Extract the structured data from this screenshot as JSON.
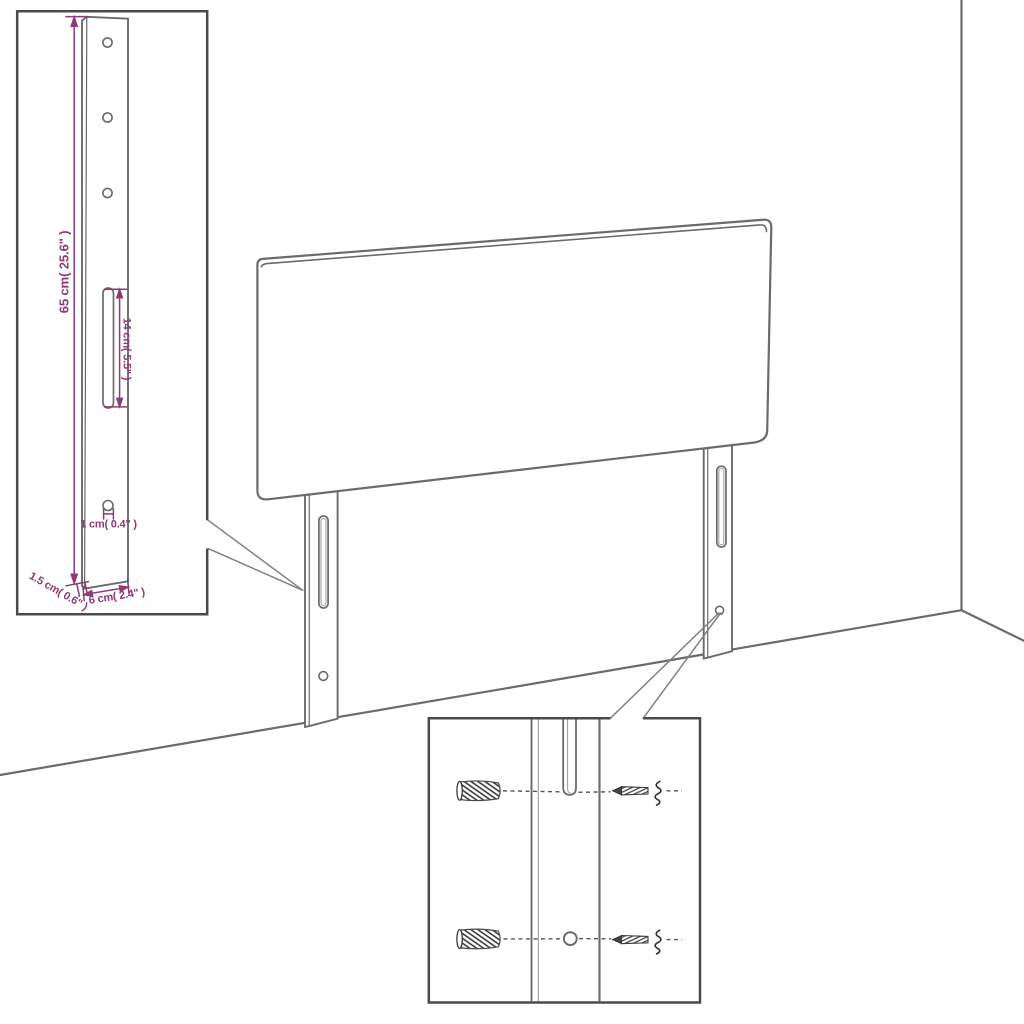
{
  "diagram": {
    "type": "furniture-assembly-dimension-diagram",
    "subject": "upholstered headboard with two slotted mounting legs shown against a room corner, with two magnifier detail insets",
    "colors": {
      "background": "#ffffff",
      "line": "#6b6b6b",
      "inset_border": "#4a4a4a",
      "dimension": "#8e3a74",
      "hardware": "#2f2f2f"
    },
    "insets": [
      {
        "id": "leg-detail",
        "description": "enlarged mounting leg: three round holes at top, long vertical slot, one screw hole near bottom",
        "dimensions": [
          {
            "id": "leg-height",
            "label": "65 cm( 25.6\" )",
            "orientation": "vertical"
          },
          {
            "id": "slot-length",
            "label": "14 cm( 5.5\" )",
            "orientation": "vertical"
          },
          {
            "id": "hole-diameter",
            "label": "1 cm( 0.4\" )",
            "orientation": "horizontal"
          },
          {
            "id": "leg-thickness",
            "label": "1.5 cm( 0.6\" )",
            "orientation": "diagonal"
          },
          {
            "id": "leg-width",
            "label": "6 cm( 2.4\" )",
            "orientation": "horizontal"
          }
        ]
      },
      {
        "id": "hardware-detail",
        "description": "enlarged leg slot and hole with two wall plugs (left) and two screws (right) aligned on dashed lines"
      }
    ]
  }
}
